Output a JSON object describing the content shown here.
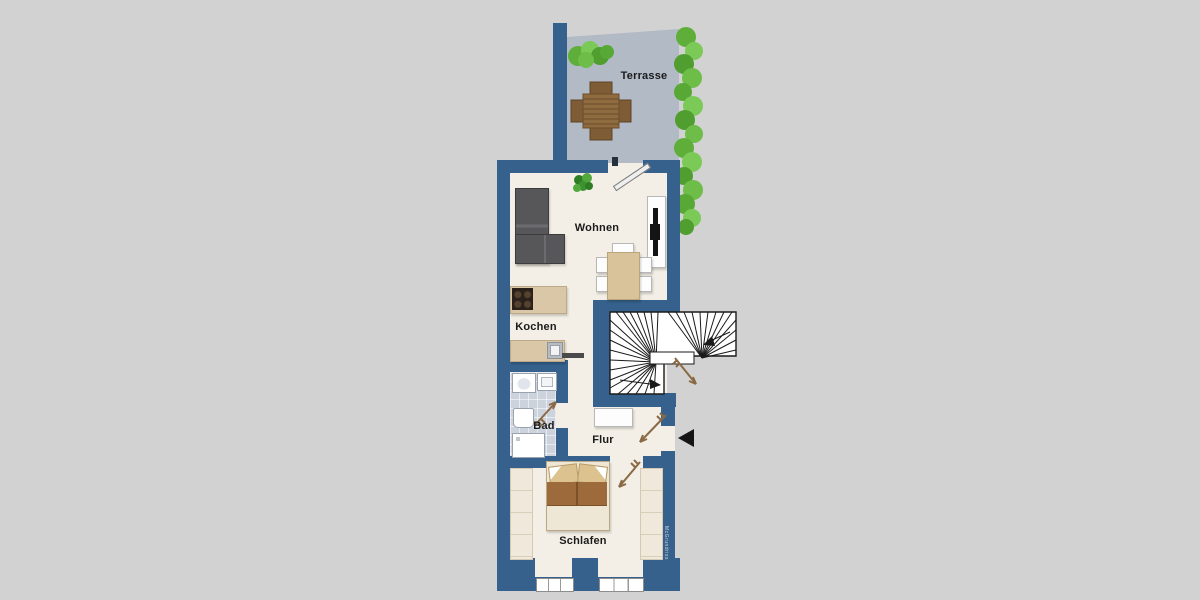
{
  "plan": {
    "background_color": "#d2d2d2",
    "wall_color": "#35618c",
    "floor_color": "#f3efe6",
    "terrace_floor_color": "#b2bac6",
    "bath_tile_color": "#cdd3dd",
    "hedge_color": "#5fae3a",
    "door_arrow_color": "#8a6a45",
    "stair_line_color": "#1a1a1a",
    "rooms": {
      "terrasse": {
        "label": "Terrasse"
      },
      "wohnen": {
        "label": "Wohnen"
      },
      "kochen": {
        "label": "Kochen"
      },
      "bad": {
        "label": "Bad"
      },
      "flur": {
        "label": "Flur"
      },
      "schlafen": {
        "label": "Schlafen"
      }
    },
    "watermark": {
      "text": "McGrundriss"
    }
  }
}
